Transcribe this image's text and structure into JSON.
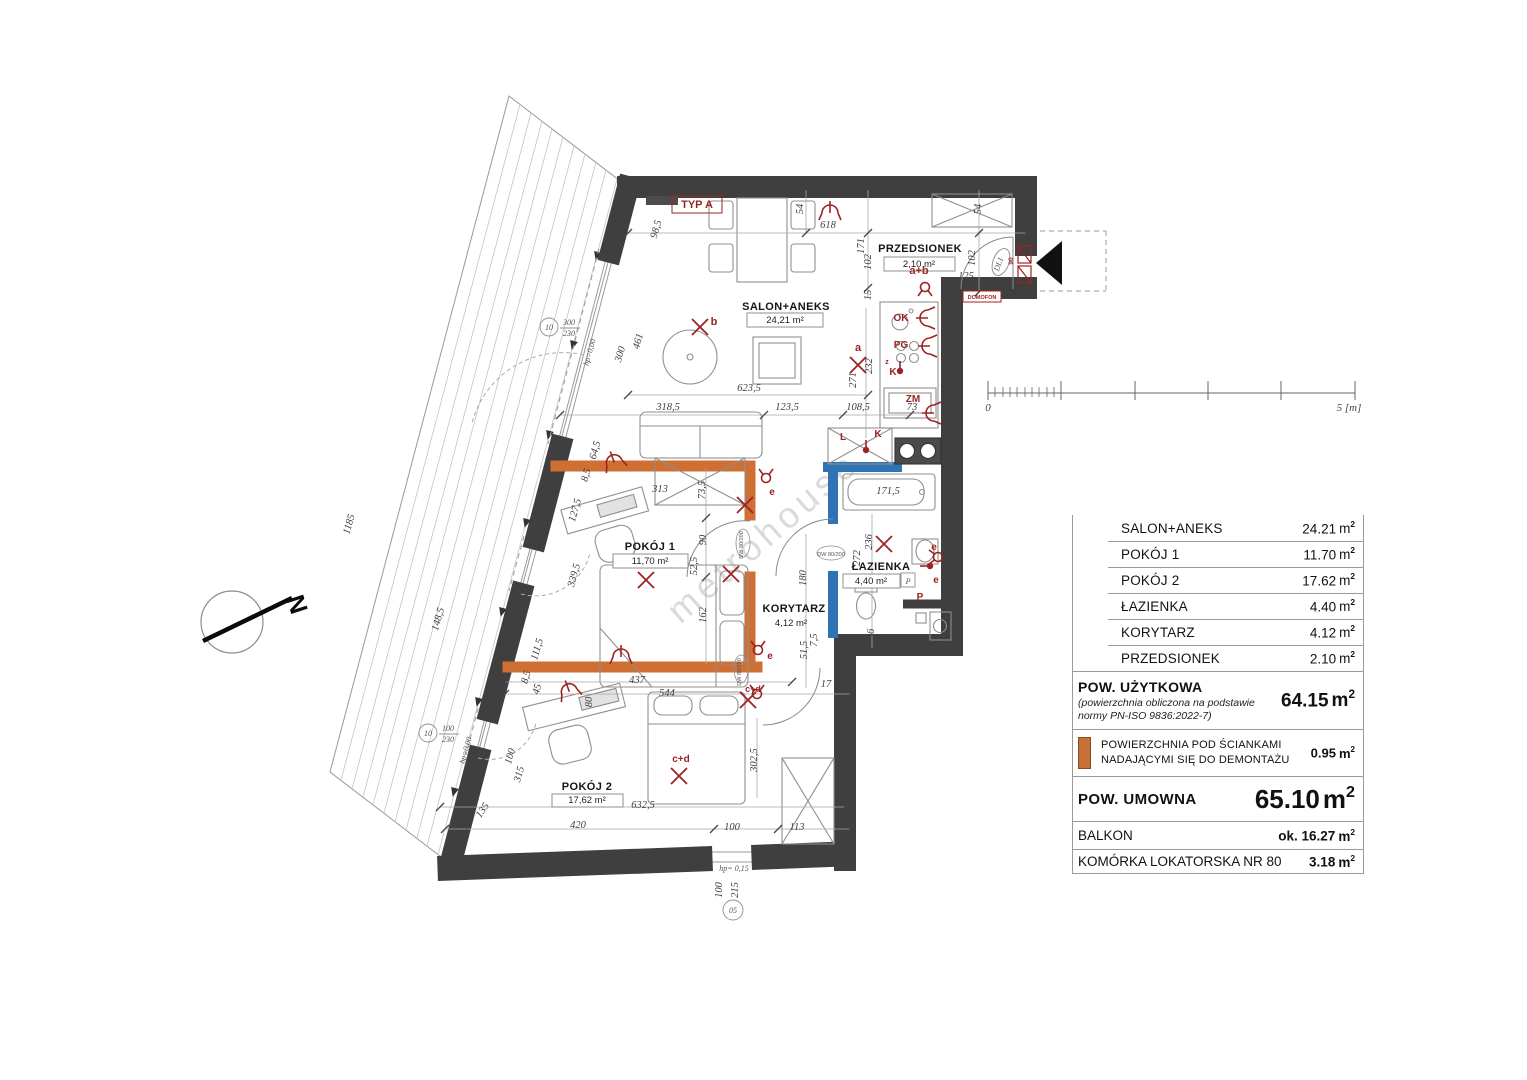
{
  "colors": {
    "wall": "#3f3f3f",
    "demountable_wall": "#cf6f33",
    "plumbing_wall": "#2e74b5",
    "annotation_red": "#9b2422",
    "swatch_orange": "#c8703a"
  },
  "plan": {
    "watermark": "metrohouse",
    "north_label": "N",
    "scalebar": {
      "zero": "0",
      "five": "5 [m]"
    },
    "rooms": [
      {
        "name": "SALON+ANEKS",
        "area": "24,21 m²",
        "nx": 786,
        "ny": 310,
        "ax": 785,
        "ay": 323,
        "box": [
          747,
          313,
          76,
          14
        ]
      },
      {
        "name": "PRZEDSIONEK",
        "area": "2,10 m²",
        "nx": 920,
        "ny": 252,
        "ax": 919,
        "ay": 267,
        "box": [
          884,
          257,
          71,
          14
        ]
      },
      {
        "name": "POKÓJ 1",
        "area": "11,70 m²",
        "nx": 650,
        "ny": 550,
        "ax": 650,
        "ay": 564,
        "box": [
          613,
          554,
          75,
          14
        ]
      },
      {
        "name": "ŁAZIENKA",
        "area": "4,40 m²",
        "nx": 881,
        "ny": 570,
        "ax": 871,
        "ay": 584,
        "box": [
          843,
          574,
          57,
          14
        ]
      },
      {
        "name": "KORYTARZ",
        "area": "4,12 m²",
        "nx": 794,
        "ny": 612,
        "ax": 791,
        "ay": 626,
        "box": null
      },
      {
        "name": "POKÓJ 2",
        "area": "17,62 m²",
        "nx": 587,
        "ny": 790,
        "ax": 587,
        "ay": 803,
        "box": [
          552,
          794,
          71,
          13
        ]
      }
    ],
    "dims": [
      {
        "t": "618",
        "x": 828,
        "y": 228,
        "r": 0
      },
      {
        "t": "54",
        "x": 803,
        "y": 209,
        "r": -90
      },
      {
        "t": "171",
        "x": 864,
        "y": 246,
        "r": -90
      },
      {
        "t": "102",
        "x": 871,
        "y": 262,
        "r": -90
      },
      {
        "t": "15",
        "x": 871,
        "y": 295,
        "r": -90
      },
      {
        "t": "54",
        "x": 981,
        "y": 209,
        "r": -90
      },
      {
        "t": "102",
        "x": 975,
        "y": 258,
        "r": -90
      },
      {
        "t": "125",
        "x": 966,
        "y": 279,
        "r": 0
      },
      {
        "t": "15",
        "x": 953,
        "y": 291,
        "r": -90
      },
      {
        "t": "98,5",
        "x": 659,
        "y": 230,
        "r": -74
      },
      {
        "t": "461",
        "x": 641,
        "y": 342,
        "r": -74
      },
      {
        "t": "300",
        "x": 623,
        "y": 355,
        "r": -74
      },
      {
        "t": "623,5",
        "x": 749,
        "y": 391,
        "r": 0
      },
      {
        "t": "318,5",
        "x": 668,
        "y": 410,
        "r": 0
      },
      {
        "t": "123,5",
        "x": 787,
        "y": 410,
        "r": 0
      },
      {
        "t": "108,5",
        "x": 858,
        "y": 410,
        "r": 0
      },
      {
        "t": "271",
        "x": 856,
        "y": 380,
        "r": -90
      },
      {
        "t": "232",
        "x": 872,
        "y": 366,
        "r": -90
      },
      {
        "t": "73",
        "x": 912,
        "y": 410,
        "r": 0
      },
      {
        "t": "64,5",
        "x": 598,
        "y": 451,
        "r": -74
      },
      {
        "t": "8,5",
        "x": 589,
        "y": 476,
        "r": -74
      },
      {
        "t": "313",
        "x": 660,
        "y": 492,
        "r": 0
      },
      {
        "t": "73,5",
        "x": 705,
        "y": 490,
        "r": -90
      },
      {
        "t": "127,5",
        "x": 578,
        "y": 511,
        "r": -74
      },
      {
        "t": "90",
        "x": 706,
        "y": 540,
        "r": -90
      },
      {
        "t": "52,5",
        "x": 697,
        "y": 566,
        "r": -90
      },
      {
        "t": "339,5",
        "x": 577,
        "y": 576,
        "r": -74
      },
      {
        "t": "162",
        "x": 706,
        "y": 615,
        "r": -90
      },
      {
        "t": "180",
        "x": 806,
        "y": 578,
        "r": -90
      },
      {
        "t": "236",
        "x": 872,
        "y": 542,
        "r": -90
      },
      {
        "t": "272",
        "x": 860,
        "y": 558,
        "r": -90
      },
      {
        "t": "171,5",
        "x": 888,
        "y": 494,
        "r": 0
      },
      {
        "t": "36",
        "x": 874,
        "y": 634,
        "r": -90
      },
      {
        "t": "7,5",
        "x": 817,
        "y": 640,
        "r": -90
      },
      {
        "t": "51,5",
        "x": 807,
        "y": 650,
        "r": -90
      },
      {
        "t": "17",
        "x": 826,
        "y": 687,
        "r": 0
      },
      {
        "t": "111,5",
        "x": 540,
        "y": 650,
        "r": -74
      },
      {
        "t": "8,5",
        "x": 529,
        "y": 678,
        "r": -74
      },
      {
        "t": "45",
        "x": 540,
        "y": 690,
        "r": -74
      },
      {
        "t": "437",
        "x": 637,
        "y": 683,
        "r": 0
      },
      {
        "t": "544",
        "x": 667,
        "y": 696,
        "r": 0
      },
      {
        "t": "80",
        "x": 592,
        "y": 702,
        "r": -90
      },
      {
        "t": "100",
        "x": 513,
        "y": 757,
        "r": -74
      },
      {
        "t": "315",
        "x": 522,
        "y": 775,
        "r": -74
      },
      {
        "t": "302,5",
        "x": 757,
        "y": 760,
        "r": -90
      },
      {
        "t": "632,5",
        "x": 643,
        "y": 808,
        "r": 0
      },
      {
        "t": "420",
        "x": 578,
        "y": 828,
        "r": 0
      },
      {
        "t": "100",
        "x": 732,
        "y": 830,
        "r": 0
      },
      {
        "t": "113",
        "x": 797,
        "y": 830,
        "r": 0
      },
      {
        "t": "74°",
        "x": 470,
        "y": 824,
        "r": -55
      },
      {
        "t": "135",
        "x": 485,
        "y": 812,
        "r": -55
      },
      {
        "t": "100",
        "x": 722,
        "y": 890,
        "r": -90
      },
      {
        "t": "215",
        "x": 738,
        "y": 890,
        "r": -90
      },
      {
        "t": "1185",
        "x": 352,
        "y": 525,
        "r": -74
      },
      {
        "t": "148,5",
        "x": 441,
        "y": 620,
        "r": -74
      }
    ],
    "red_labels": [
      {
        "t": "TYP A",
        "x": 697,
        "y": 208,
        "s": 11,
        "r": 0,
        "box": [
          672,
          196,
          50,
          17
        ]
      },
      {
        "t": "b",
        "x": 714,
        "y": 325,
        "s": 11,
        "r": 0
      },
      {
        "t": "a",
        "x": 858,
        "y": 351,
        "s": 11,
        "r": 0
      },
      {
        "t": "a+b",
        "x": 919,
        "y": 274,
        "s": 11,
        "r": 0
      },
      {
        "t": "OK",
        "x": 901,
        "y": 321,
        "s": 10,
        "r": 0
      },
      {
        "t": "PG",
        "x": 901,
        "y": 348,
        "s": 10,
        "r": 0
      },
      {
        "t": "z",
        "x": 887,
        "y": 364,
        "s": 7,
        "r": 0
      },
      {
        "t": "K",
        "x": 893,
        "y": 375,
        "s": 10,
        "r": 0
      },
      {
        "t": "ZM",
        "x": 913,
        "y": 402,
        "s": 10,
        "r": 0
      },
      {
        "t": "L",
        "x": 843,
        "y": 440,
        "s": 10,
        "r": 0
      },
      {
        "t": "K",
        "x": 878,
        "y": 437,
        "s": 10,
        "r": 0
      },
      {
        "t": "e",
        "x": 772,
        "y": 495,
        "s": 10,
        "r": 0
      },
      {
        "t": "e",
        "x": 770,
        "y": 659,
        "s": 10,
        "r": 0
      },
      {
        "t": "e",
        "x": 934,
        "y": 550,
        "s": 10,
        "r": 0
      },
      {
        "t": "e",
        "x": 936,
        "y": 583,
        "s": 10,
        "r": 0
      },
      {
        "t": "c+d",
        "x": 681,
        "y": 762,
        "s": 10,
        "r": 0
      },
      {
        "t": "c+d",
        "x": 753,
        "y": 692,
        "s": 9,
        "r": 0
      },
      {
        "t": "P",
        "x": 920,
        "y": 600,
        "s": 10,
        "r": 0
      },
      {
        "t": "DOMOFON",
        "x": 982,
        "y": 299,
        "s": 5.5,
        "r": 0,
        "box": [
          963,
          291,
          38,
          11
        ]
      },
      {
        "t": "90",
        "x": 1013,
        "y": 261,
        "s": 6.5,
        "r": -90
      }
    ],
    "gray_labels": [
      {
        "t": "DL1",
        "x": 1001,
        "y": 265,
        "s": 7,
        "r": -70
      },
      {
        "t": "P",
        "x": 908,
        "y": 584,
        "s": 8,
        "r": 0
      },
      {
        "t": "hp= 0,15",
        "x": 734,
        "y": 871,
        "s": 8,
        "r": 0
      },
      {
        "t": "05",
        "x": 733,
        "y": 913,
        "s": 8,
        "r": 0
      },
      {
        "t": "10",
        "x": 549,
        "y": 330,
        "s": 7,
        "r": 0
      },
      {
        "t": "300",
        "x": 569,
        "y": 325,
        "s": 7,
        "r": 0
      },
      {
        "t": "230",
        "x": 569,
        "y": 336,
        "s": 7,
        "r": 0
      },
      {
        "t": "10",
        "x": 428,
        "y": 736,
        "s": 7,
        "r": 0
      },
      {
        "t": "100",
        "x": 448,
        "y": 731,
        "s": 7,
        "r": 0
      },
      {
        "t": "230",
        "x": 448,
        "y": 742,
        "s": 7,
        "r": 0
      },
      {
        "t": "hp=0,00",
        "x": 592,
        "y": 353,
        "s": 6,
        "r": -74
      },
      {
        "t": "hp=0,00",
        "x": 468,
        "y": 751,
        "s": 6,
        "r": -74
      }
    ],
    "door_labels": [
      {
        "t": "DW 80/200",
        "x": 743,
        "y": 545,
        "r": -90
      },
      {
        "t": "DW 80/200",
        "x": 831,
        "y": 556,
        "r": 0
      },
      {
        "t": "DW 80/200",
        "x": 741,
        "y": 672,
        "r": -90
      }
    ]
  },
  "legend": {
    "unit": "m",
    "unit_exp": "2",
    "rows": [
      {
        "label": "SALON+ANEKS",
        "value": "24.21"
      },
      {
        "label": "POKÓJ 1",
        "value": "11.70"
      },
      {
        "label": "POKÓJ 2",
        "value": "17.62"
      },
      {
        "label": "ŁAZIENKA",
        "value": "4.40"
      },
      {
        "label": "KORYTARZ",
        "value": "4.12"
      },
      {
        "label": "PRZEDSIONEK",
        "value": "2.10"
      }
    ],
    "usable": {
      "title": "POW.  UŻYTKOWA",
      "note1": "(powierzchnia obliczona na podstawie",
      "note2": "normy PN-ISO  9836:2022-7)",
      "value": "64.15"
    },
    "demountable": {
      "line1": "POWIERZCHNIA POD ŚCIANKAMI",
      "line2": "NADAJĄCYMI SIĘ DO DEMONTAŻU",
      "value": "0.95"
    },
    "contract": {
      "title": "POW.  UMOWNA",
      "value": "65.10"
    },
    "balcony": {
      "label": "BALKON",
      "value": "ok. 16.27"
    },
    "storage": {
      "label": "KOMÓRKA LOKATORSKA NR 80",
      "value": "3.18"
    }
  }
}
